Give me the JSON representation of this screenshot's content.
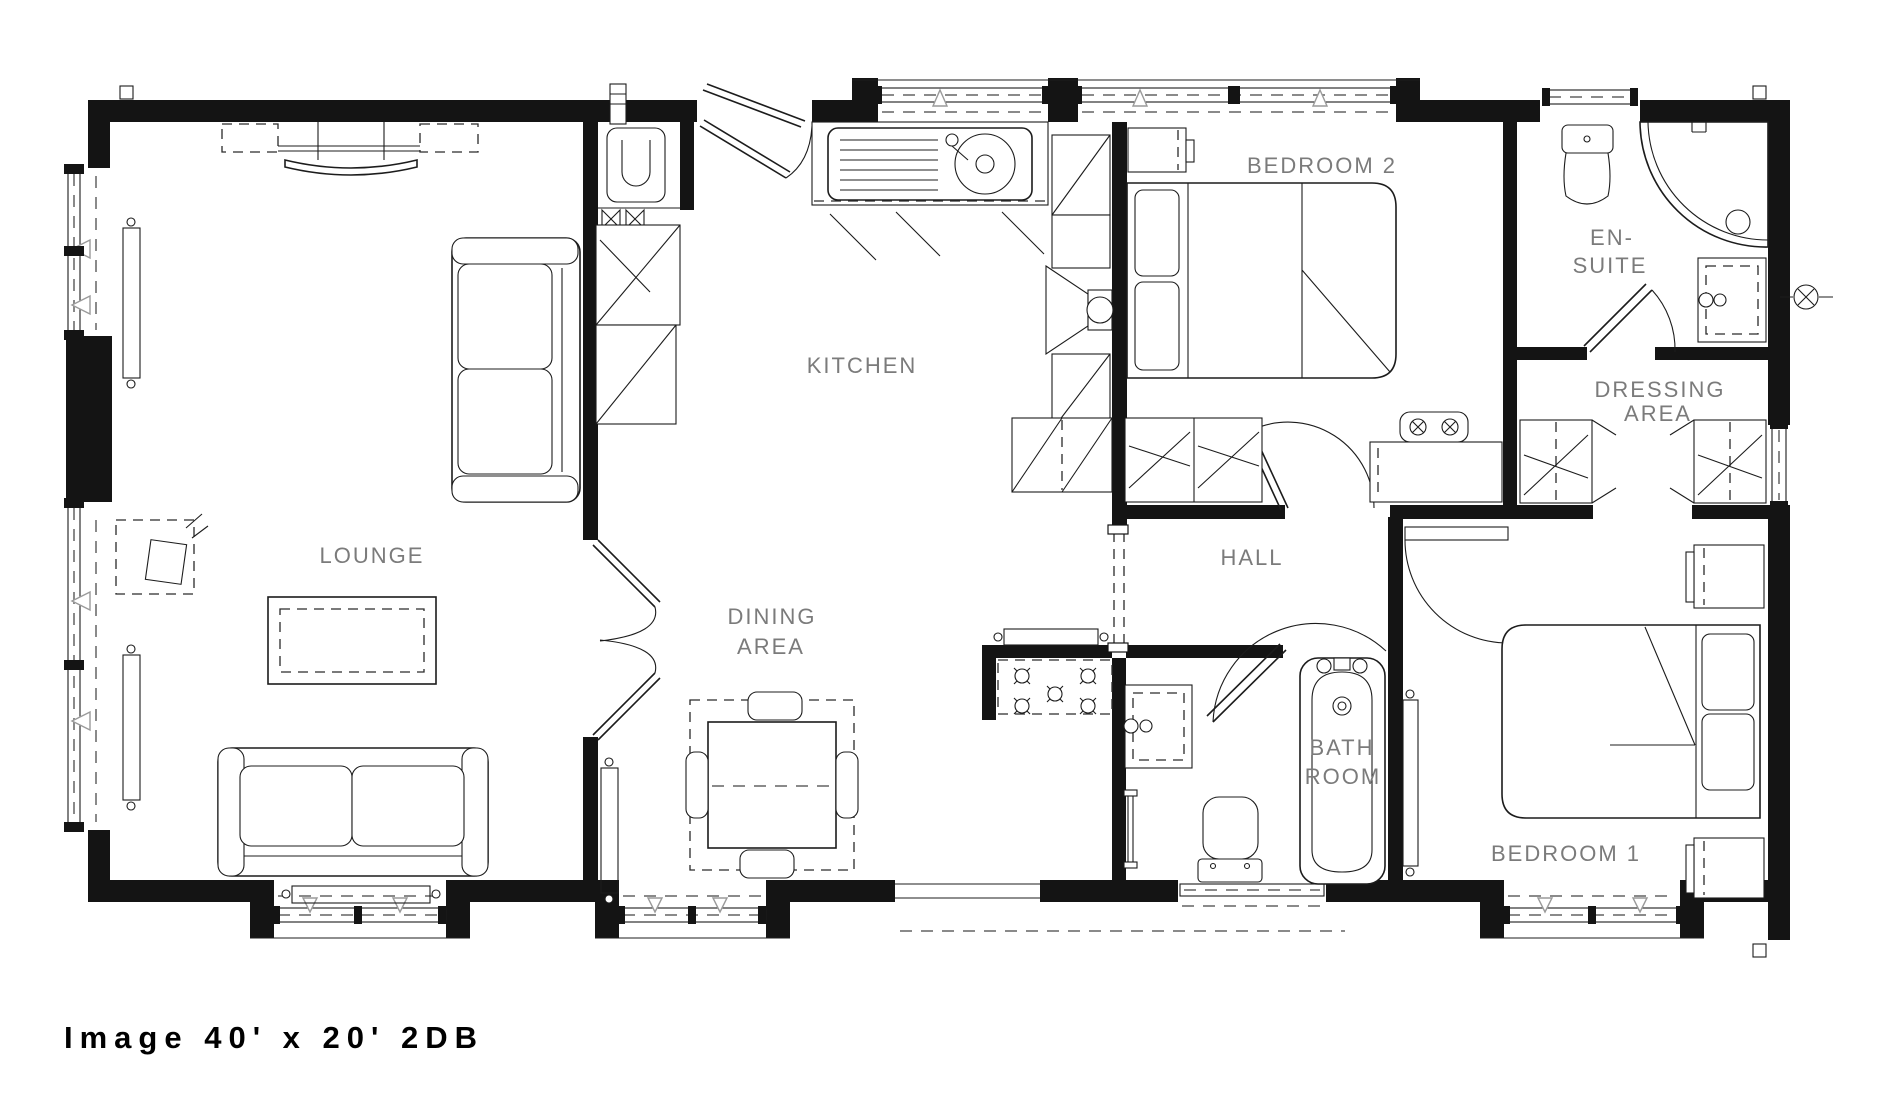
{
  "caption": "Image 40' x 20' 2DB",
  "rooms": {
    "lounge": {
      "label": "LOUNGE"
    },
    "kitchen": {
      "label": "KITCHEN"
    },
    "dining_area": {
      "line1": "DINING",
      "line2": "AREA"
    },
    "bedroom2": {
      "label": "BEDROOM 2"
    },
    "en_suite": {
      "line1": "EN-",
      "line2": "SUITE"
    },
    "dressing_area": {
      "line1": "DRESSING",
      "line2": "AREA"
    },
    "hall": {
      "label": "HALL"
    },
    "bathroom": {
      "line1": "BATH",
      "line2": "ROOM"
    },
    "bedroom1": {
      "label": "BEDROOM 1"
    }
  },
  "colors": {
    "background": "#ffffff",
    "walls": "#141414",
    "lines": "#1c1c1c",
    "labels": "#7b7b7b",
    "caption": "#000000"
  }
}
